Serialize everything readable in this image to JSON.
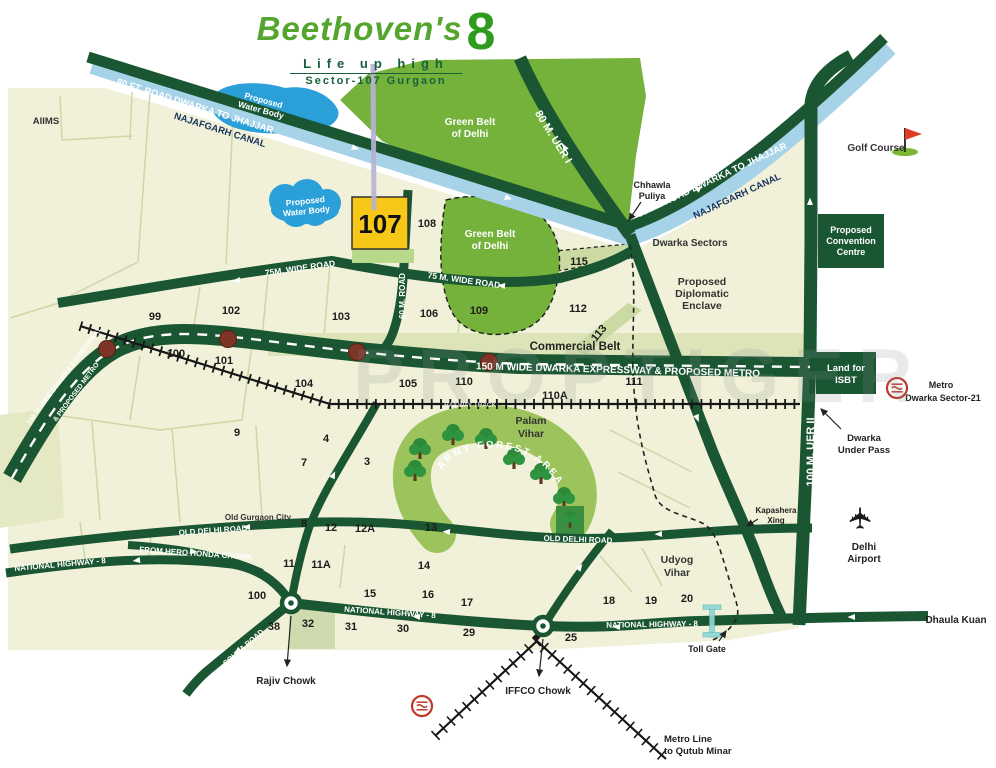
{
  "header": {
    "brand": "Beethoven's",
    "brand_number": "8",
    "tagline": "Life up high",
    "location": "Sector-107 Gurgaon"
  },
  "watermark": "PROPTIGER",
  "colors": {
    "brand_green": "#4fa32e",
    "road_green": "#1a5632",
    "canal_blue": "#a6d3e8",
    "water_blue": "#2a9fd8",
    "belt_green": "#74b23c",
    "map_cream": "#f0f1d8",
    "plot_yellow": "#f8c818",
    "metro_red": "#c0392b",
    "station_maroon": "#7c3526",
    "toll_cyan": "#8fd6d6"
  },
  "map": {
    "project_plot": {
      "number": "107"
    },
    "roads": {
      "djl": "80 FT. ROAD DWARKA TO JHAJJAR",
      "ncl": "NAJAFGARH CANAL",
      "djr": "80 FT. ROAD DWARKA TO JHAJJAR",
      "ncr": "NAJAFGARH CANAL",
      "uer1": "80 M. UER I",
      "uer2": "100 M. UER II",
      "w75a": "75M. WIDE ROAD",
      "w75b": "75 M. WIDE ROAD",
      "r60": "60 M. ROAD",
      "expwy": "150 M WIDE DWARKA EXPRESSWAY & PROPOSED METRO",
      "expwy_l1": "150 M WIDE DWARKA EXPRESSWAY",
      "expwy_l2": "& PROPOSED METRO",
      "railway": "RAILWAY TRACK",
      "odr1": "OLD DELHI ROAD",
      "odr2": "OLD DELHI ROAD",
      "nh8a": "NATIONAL HIGHWAY - 8",
      "nh8b": "NATIONAL HIGHWAY - 8",
      "nh8c": "NATIONAL HIGHWAY - 8",
      "hero": "FROM HERO HONDA CHOWK",
      "sohna": "SOHNA ROAD",
      "commercial": "Commercial Belt"
    },
    "areas": {
      "gb1a": "Green Belt",
      "gb1b": "of Delhi",
      "gb2a": "Green Belt",
      "gb2b": "of Delhi",
      "w1a": "Proposed",
      "w1b": "Water Body",
      "w2a": "Proposed",
      "w2b": "Water Body",
      "army": "ARMY FOREST AREA",
      "palam1": "Palam",
      "palam2": "Vihar",
      "udyog1": "Udyog",
      "udyog2": "Vihar",
      "dip1": "Proposed",
      "dip2": "Diplomatic",
      "dip3": "Enclave",
      "dws": "Dwarka Sectors",
      "ogc": "Old Gurgaon City",
      "aiims": "AIIMS"
    },
    "pois": {
      "chh1": "Chhawla",
      "chh2": "Puliya",
      "golf": "Golf Course",
      "conv1": "Proposed",
      "conv2": "Convention",
      "conv3": "Centre",
      "isbt1": "Land for",
      "isbt2": "ISBT",
      "m21a": "Metro",
      "m21b": "Dwarka Sector-21",
      "dup1": "Dwarka",
      "dup2": "Under Pass",
      "kap1": "Kapashera",
      "kap2": "Xing",
      "air1": "Delhi",
      "air2": "Airport",
      "dhaula": "Dhaula Kuan",
      "toll": "Toll Gate",
      "rajiv": "Rajiv Chowk",
      "iffco": "IFFCO Chowk",
      "qm1": "Metro Line",
      "qm2": "to Qutub Minar"
    },
    "sectors": [
      "99",
      "102",
      "103",
      "106",
      "109",
      "112",
      "113",
      "115",
      "108",
      "104",
      "105",
      "110",
      "110A",
      "111",
      "100",
      "101",
      "9",
      "4",
      "7",
      "3",
      "8",
      "12",
      "12A",
      "13",
      "14",
      "11",
      "11A",
      "100",
      "15",
      "16",
      "17",
      "38",
      "32",
      "31",
      "30",
      "29",
      "25",
      "18",
      "19",
      "20"
    ]
  }
}
